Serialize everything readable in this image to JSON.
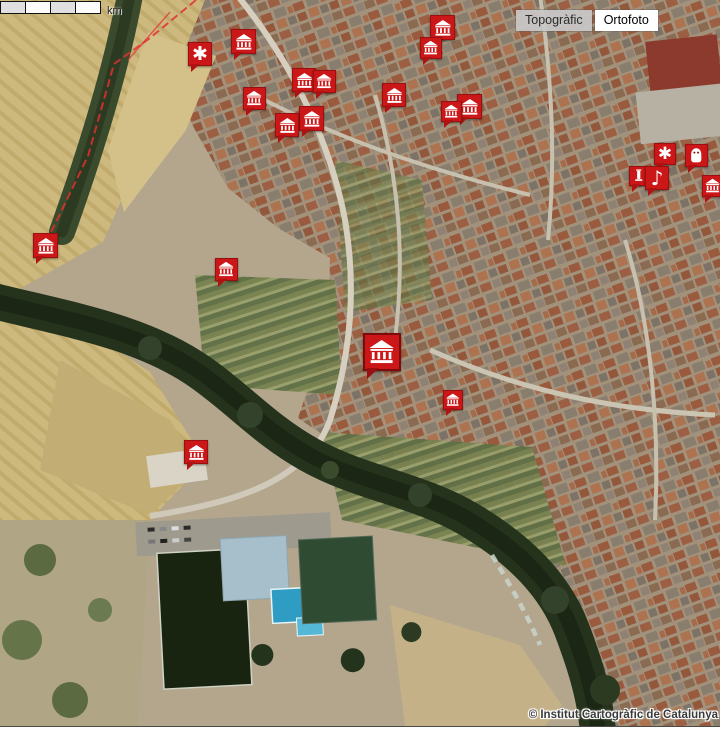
{
  "map": {
    "attribution": "© Institut Cartogràfic de Catalunya",
    "scale_bar": {
      "label": "km",
      "segments": 4
    },
    "layer_toggle": {
      "options": [
        {
          "label": "Topogràfic",
          "active": false
        },
        {
          "label": "Ortofoto",
          "active": true
        }
      ]
    },
    "marker_color": "#cb1717",
    "icons": {
      "asterisk": "✱",
      "music": "♪",
      "museum": "classical-building",
      "statue": "white-figure",
      "monument": "column"
    },
    "markers": [
      {
        "type": "asterisk",
        "x": 188,
        "y": 42,
        "size": 24
      },
      {
        "type": "museum",
        "x": 231,
        "y": 29,
        "size": 25
      },
      {
        "type": "museum",
        "x": 430,
        "y": 15,
        "size": 25
      },
      {
        "type": "museum",
        "x": 420,
        "y": 37,
        "size": 22
      },
      {
        "type": "museum",
        "x": 292,
        "y": 68,
        "size": 24
      },
      {
        "type": "museum",
        "x": 313,
        "y": 70,
        "size": 23
      },
      {
        "type": "museum",
        "x": 243,
        "y": 87,
        "size": 23
      },
      {
        "type": "museum",
        "x": 382,
        "y": 83,
        "size": 24
      },
      {
        "type": "museum",
        "x": 457,
        "y": 94,
        "size": 25
      },
      {
        "type": "museum",
        "x": 441,
        "y": 101,
        "size": 21
      },
      {
        "type": "museum",
        "x": 299,
        "y": 106,
        "size": 25
      },
      {
        "type": "museum",
        "x": 275,
        "y": 113,
        "size": 24
      },
      {
        "type": "asterisk",
        "x": 654,
        "y": 143,
        "size": 22
      },
      {
        "type": "statue",
        "x": 685,
        "y": 144,
        "size": 23
      },
      {
        "type": "monument",
        "x": 629,
        "y": 166,
        "size": 20
      },
      {
        "type": "music",
        "x": 645,
        "y": 166,
        "size": 24
      },
      {
        "type": "museum",
        "x": 702,
        "y": 175,
        "size": 22
      },
      {
        "type": "museum",
        "x": 33,
        "y": 233,
        "size": 25
      },
      {
        "type": "museum",
        "x": 215,
        "y": 258,
        "size": 23
      },
      {
        "type": "museum",
        "x": 363,
        "y": 333,
        "size": 38
      },
      {
        "type": "museum",
        "x": 443,
        "y": 390,
        "size": 20
      },
      {
        "type": "museum",
        "x": 184,
        "y": 440,
        "size": 24
      }
    ]
  }
}
